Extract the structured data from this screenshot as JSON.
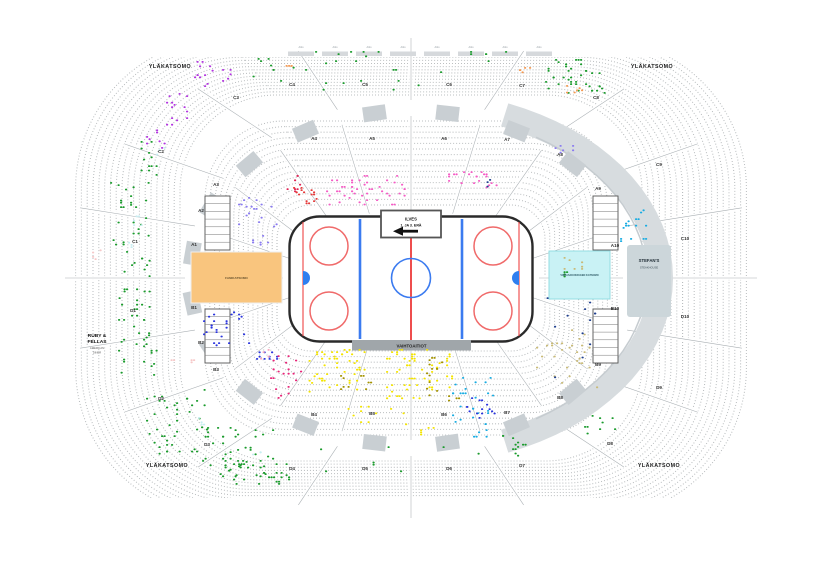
{
  "corner_label": "YLÄKATSOMO",
  "rink": {
    "attack_box_line1": "ILVES",
    "attack_box_line2": "1. JA 3. ERÄ",
    "benches_label": "VAIHTOAITIOT"
  },
  "areas": {
    "fan_stand": {
      "label": "FANIKATSOMO",
      "color": "#f9c57e"
    },
    "away_stand": {
      "label": "VIERASJOUKKUEEN KATSOMO",
      "color": "#c9f2f5"
    },
    "restaurant_left": {
      "line1": "RUBY &",
      "line2": "FELLAS",
      "sub1": "AMERICAN",
      "sub2": "DINER"
    },
    "restaurant_right": {
      "name": "STEFAN'S",
      "sub": "STEAKHOUSE"
    },
    "suite_label": "Aitio",
    "suite_count": 8
  },
  "sections": {
    "A": [
      {
        "label": "A1",
        "x": 194,
        "y": 246
      },
      {
        "label": "A2",
        "x": 201,
        "y": 212
      },
      {
        "label": "A3",
        "x": 216,
        "y": 186
      },
      {
        "label": "A4",
        "x": 314,
        "y": 140
      },
      {
        "label": "A5",
        "x": 372,
        "y": 140
      },
      {
        "label": "A6",
        "x": 444,
        "y": 140
      },
      {
        "label": "A7",
        "x": 507,
        "y": 141
      },
      {
        "label": "A8",
        "x": 560,
        "y": 156
      },
      {
        "label": "A9",
        "x": 598,
        "y": 190
      },
      {
        "label": "A10",
        "x": 615,
        "y": 247
      }
    ],
    "B": [
      {
        "label": "B1",
        "x": 194,
        "y": 309
      },
      {
        "label": "B2",
        "x": 201,
        "y": 344
      },
      {
        "label": "B3",
        "x": 216,
        "y": 371
      },
      {
        "label": "B4",
        "x": 314,
        "y": 416
      },
      {
        "label": "B5",
        "x": 372,
        "y": 415
      },
      {
        "label": "B6",
        "x": 444,
        "y": 416
      },
      {
        "label": "B7",
        "x": 507,
        "y": 414
      },
      {
        "label": "B8",
        "x": 560,
        "y": 399
      },
      {
        "label": "B9",
        "x": 598,
        "y": 366
      },
      {
        "label": "B10",
        "x": 615,
        "y": 310
      }
    ],
    "C": [
      {
        "label": "C1",
        "x": 135,
        "y": 243
      },
      {
        "label": "C2",
        "x": 161,
        "y": 153
      },
      {
        "label": "C3",
        "x": 236,
        "y": 99
      },
      {
        "label": "C4",
        "x": 292,
        "y": 86
      },
      {
        "label": "C5",
        "x": 365,
        "y": 86
      },
      {
        "label": "C6",
        "x": 449,
        "y": 86
      },
      {
        "label": "C7",
        "x": 522,
        "y": 87
      },
      {
        "label": "C8",
        "x": 596,
        "y": 99
      },
      {
        "label": "C9",
        "x": 659,
        "y": 166
      },
      {
        "label": "C10",
        "x": 685,
        "y": 240
      }
    ],
    "D": [
      {
        "label": "D1",
        "x": 133,
        "y": 312
      },
      {
        "label": "D2",
        "x": 161,
        "y": 400
      },
      {
        "label": "D3",
        "x": 207,
        "y": 446
      },
      {
        "label": "D4",
        "x": 292,
        "y": 470
      },
      {
        "label": "D5",
        "x": 365,
        "y": 470
      },
      {
        "label": "D6",
        "x": 449,
        "y": 470
      },
      {
        "label": "D7",
        "x": 522,
        "y": 467
      },
      {
        "label": "D8",
        "x": 610,
        "y": 445
      },
      {
        "label": "D9",
        "x": 659,
        "y": 389
      },
      {
        "label": "D10",
        "x": 685,
        "y": 318
      }
    ]
  },
  "seat_colors": {
    "green": "#1a9b2c",
    "orange": "#f59a52",
    "purple": "#b233e0",
    "violet": "#8a7bf0",
    "blue": "#2b35dd",
    "navy": "#20408f",
    "hotpink": "#f55cc5",
    "deeppink": "#e82578",
    "crimson": "#e02455",
    "red": "#e43a3a",
    "pinklight": "#f7a8bd",
    "pinkpale": "#f6c8c8",
    "yellow": "#f4e400",
    "olive": "#a39200",
    "khaki": "#c9ba76",
    "cyan": "#18ace2",
    "cyanpale": "#c7edf1"
  },
  "clusters": [
    [
      250,
      58,
      258,
      36,
      "green",
      24
    ],
    [
      545,
      59,
      42,
      36,
      "green",
      30
    ],
    [
      586,
      70,
      18,
      24,
      "green",
      10
    ],
    [
      300,
      51,
      80,
      5,
      "green",
      6
    ],
    [
      470,
      51,
      70,
      5,
      "green",
      5
    ],
    [
      283,
      65,
      10,
      8,
      "orange",
      4
    ],
    [
      519,
      67,
      12,
      7,
      "orange",
      5
    ],
    [
      566,
      85,
      16,
      8,
      "orange",
      6
    ],
    [
      194,
      61,
      22,
      27,
      "purple",
      12
    ],
    [
      222,
      69,
      10,
      15,
      "purple",
      5
    ],
    [
      166,
      93,
      28,
      32,
      "purple",
      14
    ],
    [
      146,
      125,
      20,
      25,
      "purple",
      8
    ],
    [
      138,
      141,
      22,
      38,
      "green",
      12
    ],
    [
      156,
      147,
      9,
      9,
      "cyanpale",
      3
    ],
    [
      110,
      182,
      40,
      64,
      "green",
      26
    ],
    [
      116,
      251,
      36,
      66,
      "green",
      26
    ],
    [
      118,
      319,
      40,
      58,
      "green",
      26
    ],
    [
      128,
      211,
      16,
      42,
      "cyanpale",
      8
    ],
    [
      92,
      245,
      9,
      16,
      "pinkpale",
      4
    ],
    [
      146,
      389,
      62,
      66,
      "green",
      44
    ],
    [
      202,
      427,
      72,
      50,
      "green",
      48
    ],
    [
      228,
      461,
      62,
      28,
      "green",
      30
    ],
    [
      168,
      357,
      28,
      10,
      "pinkpale",
      5
    ],
    [
      198,
      417,
      12,
      10,
      "cyanpale",
      4
    ],
    [
      252,
      447,
      10,
      8,
      "cyanpale",
      3
    ],
    [
      238,
      197,
      40,
      30,
      "violet",
      18
    ],
    [
      252,
      235,
      16,
      12,
      "violet",
      6
    ],
    [
      203,
      307,
      46,
      40,
      "blue",
      26
    ],
    [
      256,
      347,
      28,
      16,
      "blue",
      10
    ],
    [
      270,
      353,
      32,
      48,
      "deeppink",
      20
    ],
    [
      260,
      349,
      12,
      10,
      "pinklight",
      4
    ],
    [
      284,
      175,
      18,
      18,
      "crimson",
      8
    ],
    [
      293,
      187,
      26,
      18,
      "red",
      16
    ],
    [
      326,
      175,
      84,
      30,
      "hotpink",
      46
    ],
    [
      448,
      169,
      50,
      20,
      "hotpink",
      22
    ],
    [
      484,
      179,
      8,
      7,
      "navy",
      3
    ],
    [
      536,
      327,
      62,
      62,
      "khaki",
      30
    ],
    [
      544,
      295,
      56,
      84,
      "navy",
      12
    ],
    [
      556,
      257,
      30,
      14,
      "khaki",
      7
    ],
    [
      552,
      145,
      26,
      12,
      "violet",
      6
    ],
    [
      306,
      349,
      60,
      44,
      "yellow",
      48
    ],
    [
      386,
      349,
      70,
      50,
      "yellow",
      58
    ],
    [
      345,
      397,
      70,
      28,
      "yellow",
      12
    ],
    [
      420,
      427,
      22,
      10,
      "yellow",
      5
    ],
    [
      340,
      375,
      32,
      18,
      "olive",
      10
    ],
    [
      426,
      357,
      16,
      38,
      "olive",
      14
    ],
    [
      448,
      393,
      12,
      10,
      "olive",
      4
    ],
    [
      452,
      377,
      42,
      48,
      "cyan",
      26
    ],
    [
      468,
      427,
      20,
      10,
      "cyan",
      5
    ],
    [
      466,
      395,
      30,
      24,
      "blue",
      14
    ],
    [
      620,
      205,
      28,
      40,
      "cyan",
      16
    ],
    [
      502,
      435,
      32,
      22,
      "green",
      12
    ],
    [
      584,
      415,
      32,
      20,
      "green",
      9
    ],
    [
      556,
      269,
      18,
      10,
      "green",
      4
    ],
    [
      300,
      444,
      200,
      34,
      "green",
      8
    ]
  ],
  "style": {
    "seat_dot": "#b4b8ba",
    "walkway": "#d7dcdf",
    "walkway_edge": "#c6ccd0",
    "block": "#c9cfd3",
    "ice_border": "#2a2a2a",
    "ice_line_red": "#ee4444",
    "ice_line_blue": "#3b7bf0",
    "crease": "#2f7ff0",
    "bench_bar": "#a0a6aa",
    "suite_bar": "#d6d9dc",
    "panel": "#ccd6da",
    "label": "#333333"
  }
}
